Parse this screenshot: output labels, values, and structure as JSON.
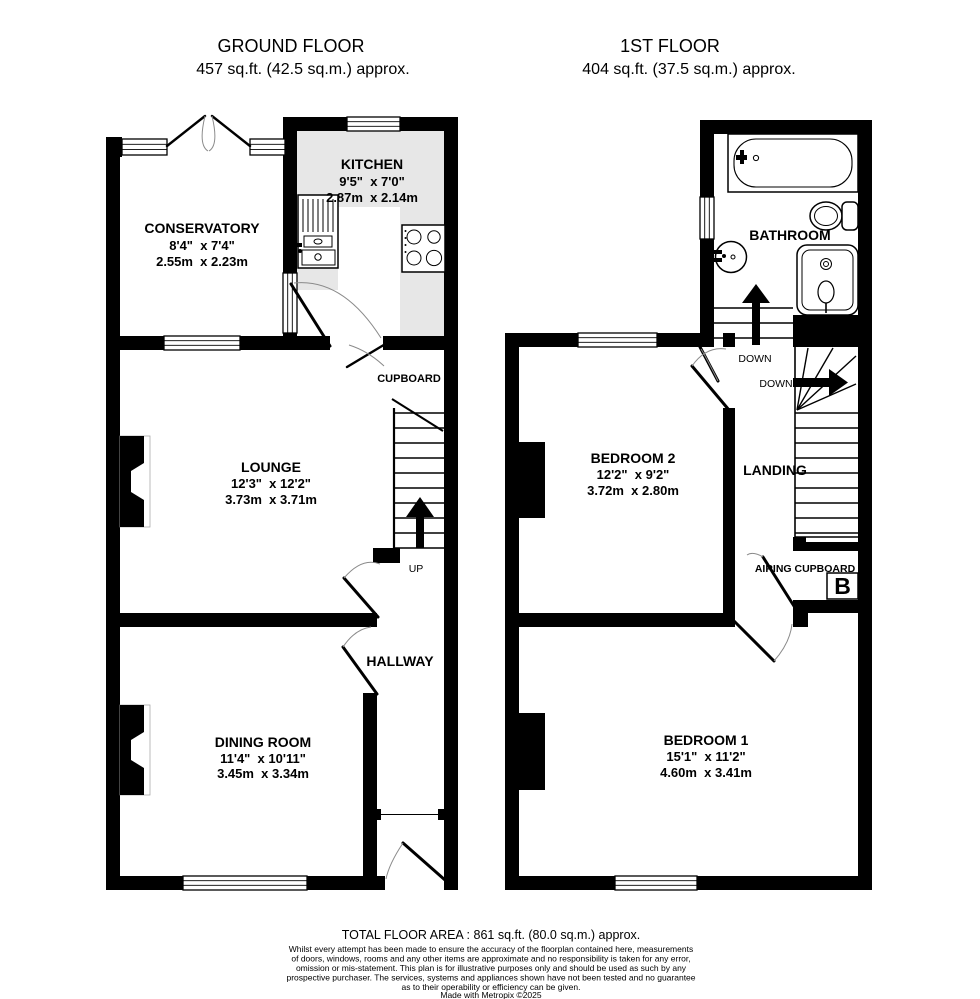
{
  "ground_floor": {
    "title": "GROUND FLOOR",
    "subtitle": "457 sq.ft. (42.5 sq.m.) approx.",
    "rooms": {
      "conservatory": {
        "name": "CONSERVATORY",
        "imperial": "8'4\"  x 7'4\"",
        "metric": "2.55m  x 2.23m"
      },
      "kitchen": {
        "name": "KITCHEN",
        "imperial": "9'5\"  x 7'0\"",
        "metric": "2.87m  x 2.14m"
      },
      "lounge": {
        "name": "LOUNGE",
        "imperial": "12'3\"  x 12'2\"",
        "metric": "3.73m  x 3.71m"
      },
      "dining_room": {
        "name": "DINING ROOM",
        "imperial": "11'4\"  x 10'11\"",
        "metric": "3.45m  x 3.34m"
      },
      "hallway": {
        "name": "HALLWAY"
      },
      "cupboard": {
        "name": "CUPBOARD"
      }
    },
    "stairs_label": "UP"
  },
  "first_floor": {
    "title": "1ST FLOOR",
    "subtitle": "404 sq.ft. (37.5 sq.m.) approx.",
    "rooms": {
      "bathroom": {
        "name": "BATHROOM"
      },
      "bedroom2": {
        "name": "BEDROOM 2",
        "imperial": "12'2\"  x 9'2\"",
        "metric": "3.72m  x 2.80m"
      },
      "bedroom1": {
        "name": "BEDROOM 1",
        "imperial": "15'1\"  x 11'2\"",
        "metric": "4.60m  x 3.41m"
      },
      "landing": {
        "name": "LANDING"
      },
      "airing_cupboard": {
        "name": "AIRING CUPBOARD"
      }
    },
    "stairs_labels": {
      "down1": "DOWN",
      "down2": "DOWN"
    },
    "boiler_symbol": "B"
  },
  "footer": {
    "total_area": "TOTAL FLOOR AREA : 861 sq.ft. (80.0 sq.m.) approx.",
    "disclaimer_lines": [
      "Whilst every attempt has been made to ensure the accuracy of the floorplan contained here, measurements",
      "of doors, windows, rooms and any other items are approximate and no responsibility is taken for any error,",
      "omission or mis-statement. This plan is for illustrative purposes only and should be used as such by any",
      "prospective purchaser. The services, systems and appliances shown have not been tested and no guarantee",
      "as to their operability or efficiency can be given."
    ],
    "credit": "Made with Metropix ©2025"
  },
  "colors": {
    "wall": "#000000",
    "kitchen_counter": "#e7e7e7",
    "background": "#ffffff"
  }
}
